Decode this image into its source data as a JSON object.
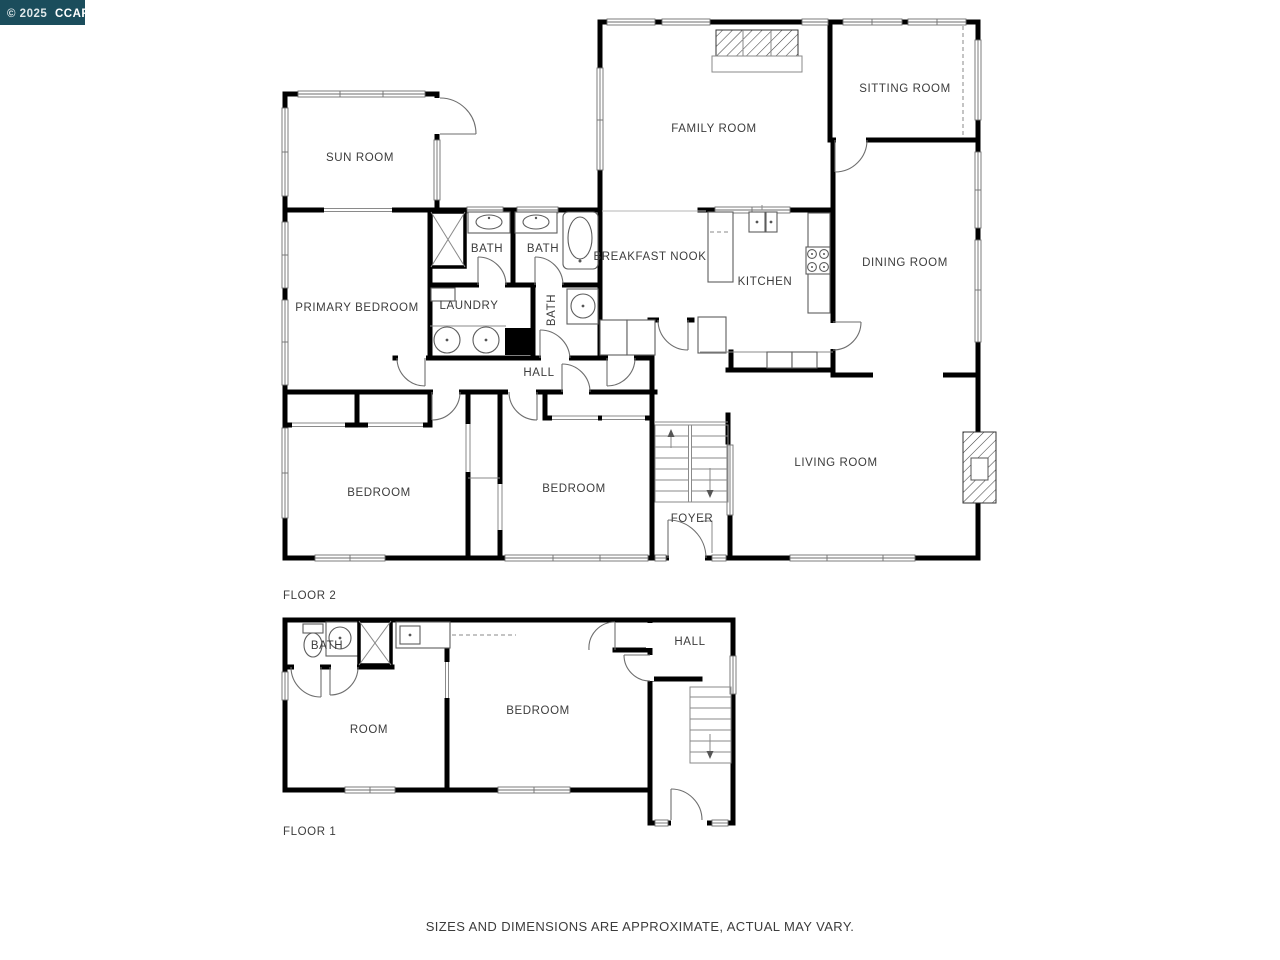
{
  "watermark": {
    "prefix": "© 2025",
    "name": "CCAR",
    "bg_color": "#1b4d5c"
  },
  "disclaimer": "SIZES AND DIMENSIONS ARE APPROXIMATE, ACTUAL MAY VARY.",
  "colors": {
    "wall": "#000000",
    "thin_line": "#8a8a8a",
    "label": "#3c3c3c",
    "background": "#ffffff",
    "watermark_bg": "#1b4d5c"
  },
  "floors": [
    {
      "name": "FLOOR 2",
      "rooms": [
        {
          "label": "SUN ROOM"
        },
        {
          "label": "FAMILY ROOM"
        },
        {
          "label": "SITTING ROOM"
        },
        {
          "label": "BATH"
        },
        {
          "label": "BATH"
        },
        {
          "label": "BREAKFAST NOOK"
        },
        {
          "label": "KITCHEN"
        },
        {
          "label": "DINING ROOM"
        },
        {
          "label": "PRIMARY BEDROOM"
        },
        {
          "label": "LAUNDRY"
        },
        {
          "label": "BATH"
        },
        {
          "label": "HALL"
        },
        {
          "label": "BEDROOM"
        },
        {
          "label": "BEDROOM"
        },
        {
          "label": "FOYER"
        },
        {
          "label": "LIVING ROOM"
        }
      ]
    },
    {
      "name": "FLOOR 1",
      "rooms": [
        {
          "label": "BATH"
        },
        {
          "label": "HALL"
        },
        {
          "label": "ROOM"
        },
        {
          "label": "BEDROOM"
        }
      ]
    }
  ]
}
